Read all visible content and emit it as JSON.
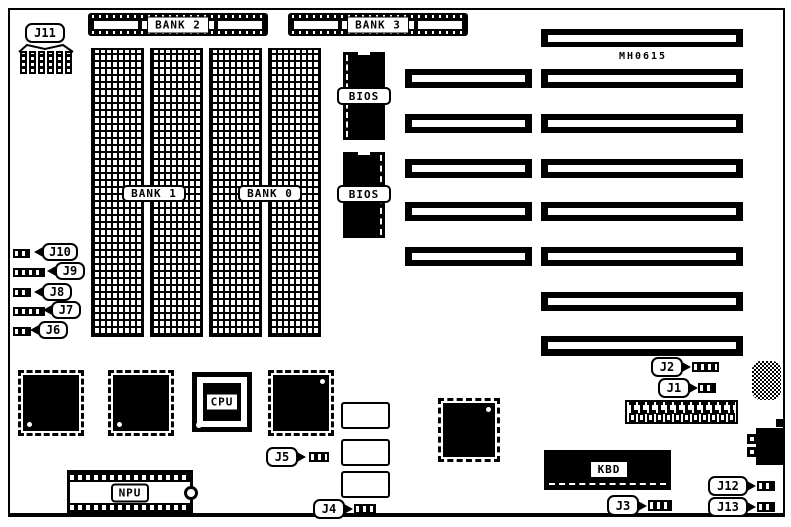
{
  "board": {
    "model_text": "MH0615"
  },
  "memory_banks": {
    "bank0": "BANK 0",
    "bank1": "BANK 1",
    "bank2": "BANK 2",
    "bank3": "BANK 3"
  },
  "chips": {
    "bios_top": "BIOS",
    "bios_bottom": "BIOS",
    "cpu": "CPU",
    "npu": "NPU",
    "keyboard_controller": "KBD"
  },
  "jumpers": {
    "j1": "J1",
    "j2": "J2",
    "j3": "J3",
    "j4": "J4",
    "j5": "J5",
    "j6": "J6",
    "j7": "J7",
    "j8": "J8",
    "j9": "J9",
    "j10": "J10",
    "j11": "J11",
    "j12": "J12",
    "j13": "J13"
  },
  "colors": {
    "ink": "#000000",
    "paper": "#ffffff"
  }
}
